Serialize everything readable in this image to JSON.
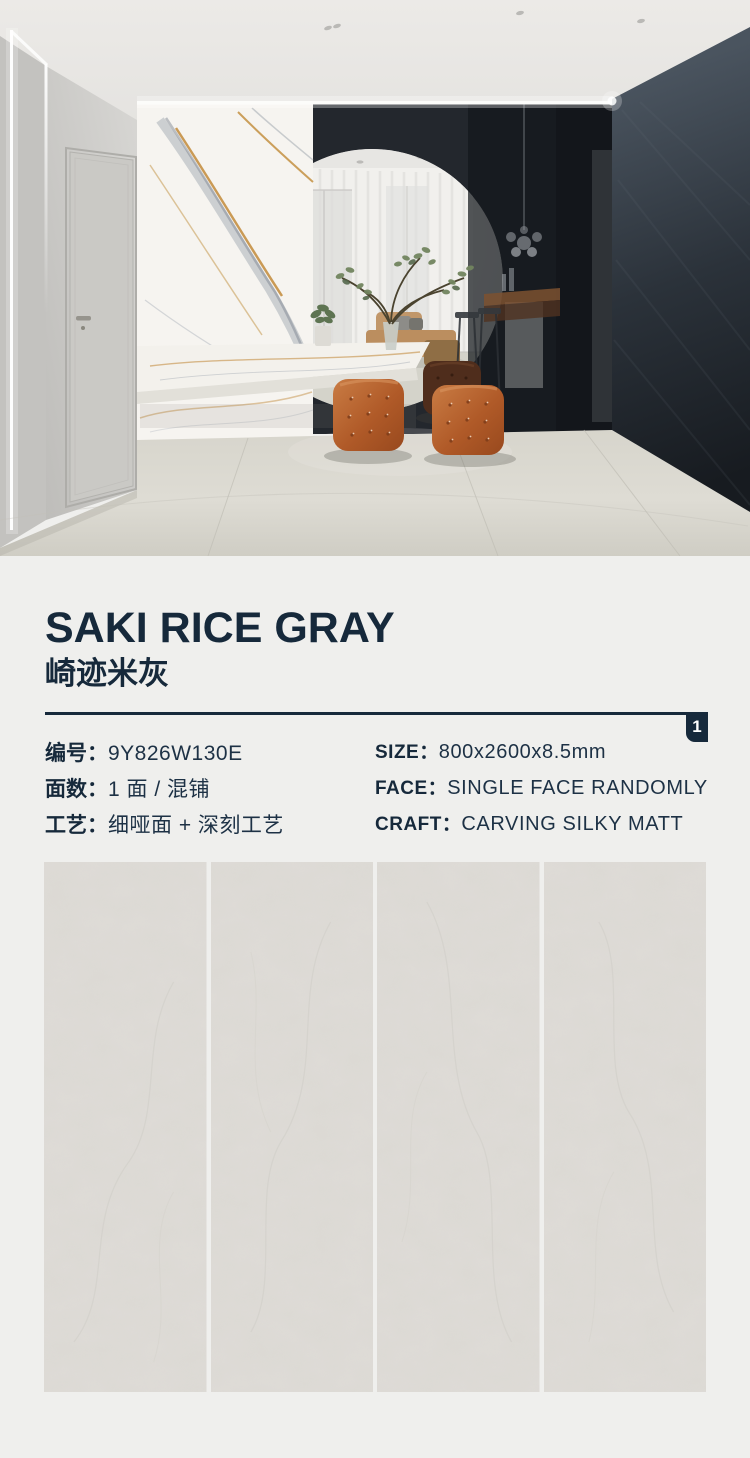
{
  "product": {
    "title_en": "SAKI RICE GRAY",
    "title_zh": "崎迹米灰",
    "badge": "1",
    "specs_zh": [
      {
        "label": "编号：",
        "value": "9Y826W130E"
      },
      {
        "label": "面数：",
        "value": "1 面 / 混铺"
      },
      {
        "label": "工艺：",
        "value": "细哑面 + 深刻工艺"
      }
    ],
    "specs_en": [
      {
        "label": "SIZE：",
        "value": "800x2600x8.5mm"
      },
      {
        "label": "FACE：",
        "value": "SINGLE FACE RANDOMLY"
      },
      {
        "label": "CRAFT：",
        "value": "CARVING SILKY MATT"
      }
    ]
  },
  "tiles": {
    "count": 4
  },
  "colors": {
    "navy": "#16293b",
    "page_bg": "#efefed",
    "tile": "#dcd9d4",
    "accent_orange": "#b05a28",
    "marble_gold": "#c28a3a"
  }
}
